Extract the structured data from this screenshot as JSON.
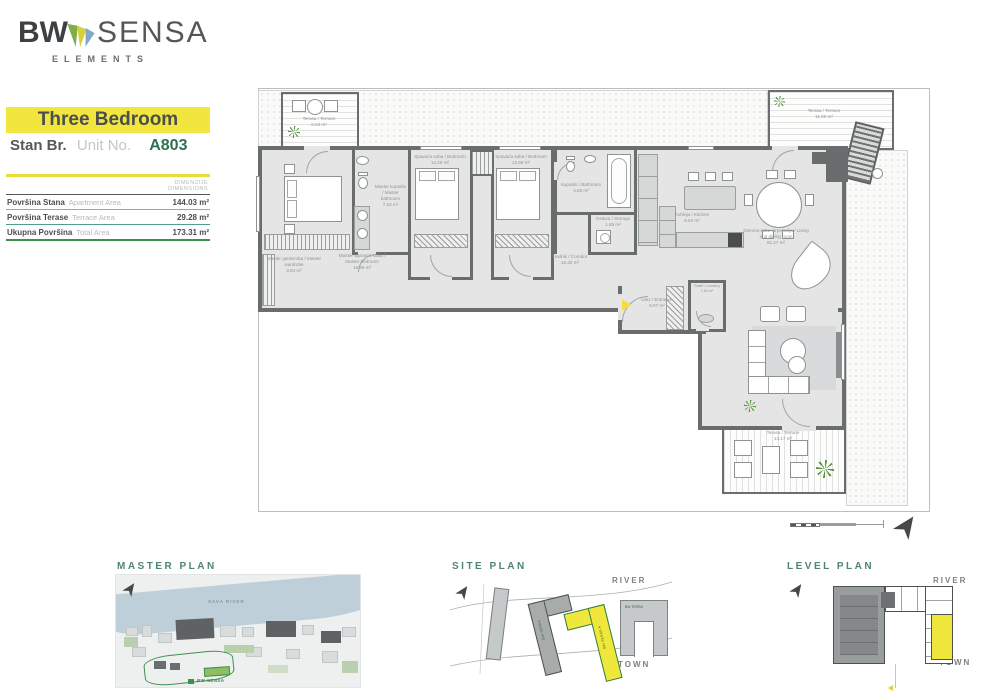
{
  "brand": {
    "bw": "BW",
    "sensa": "SENSA",
    "tagline": "ELEMENTS"
  },
  "header": {
    "unit_type": "Three Bedroom",
    "stan_label": "Stan Br.",
    "unit_label": "Unit No.",
    "unit_number": "A803"
  },
  "dimensions_table": {
    "header_sr": "DIMENZIJE",
    "header_en": "DIMENSIONS",
    "rows": [
      {
        "sr": "Površina Stana",
        "en": "Apartment Area",
        "value": "144.03 m²"
      },
      {
        "sr": "Površina Terase",
        "en": "Terrace Area",
        "value": "29.28 m²"
      },
      {
        "sr": "Ukupna Površina",
        "en": "Total Area",
        "value": "173.31 m²"
      }
    ]
  },
  "plan": {
    "rooms": [
      {
        "name": "Master spavaća soba / Master bedroom",
        "area": "16.99 m²"
      },
      {
        "name": "Master garderoba / Master wardrobe",
        "area": "3.94 m²"
      },
      {
        "name": "Master kupatilo / Master bathroom",
        "area": "7.22 m²"
      },
      {
        "name": "Spavaća soba / Bedroom",
        "area": "12.26 m²"
      },
      {
        "name": "Spavaća soba / Bedroom",
        "area": "12.68 m²"
      },
      {
        "name": "Kupatilo / Bathroom",
        "area": "4.88 m²"
      },
      {
        "name": "Ostava / Storage",
        "area": "1.85 m²"
      },
      {
        "name": "Kuhinja / Kitchen",
        "area": "8.94 m²"
      },
      {
        "name": "Dnevna soba i trpezarija / Living and dining room",
        "area": "61.27 m²"
      },
      {
        "name": "Hodnik / Corridor",
        "area": "16.32 m²"
      },
      {
        "name": "Ulaz / Entrance",
        "area": "6.07 m²"
      },
      {
        "name": "Toalet / Lavatory",
        "area": "1.80 m²"
      },
      {
        "name": "Terasa / Terrace",
        "area": "6.03 m²"
      },
      {
        "name": "Terasa / Terrace",
        "area": "11.60 m²"
      },
      {
        "name": "Terasa / Terrace",
        "area": "13.17 m²"
      }
    ]
  },
  "mini_plans": {
    "master": {
      "title": "MASTER PLAN",
      "river_label": "SAVA RIVER",
      "site_label": "BW SENSA"
    },
    "site": {
      "title": "SITE PLAN",
      "river_label": "RIVER",
      "town_label": "TOWN",
      "building_gray": "BW SENSA",
      "building_highlight": "BW SENSA A",
      "building_right": "BW TERRA"
    },
    "level": {
      "title": "LEVEL PLAN",
      "river_label": "RIVER",
      "town_label": "TOWN"
    }
  },
  "colors": {
    "accent_yellow": "#f2e63e",
    "brand_green": "#2e7050",
    "wall_gray": "#6a6d6e",
    "title_teal": "#4d8571"
  }
}
